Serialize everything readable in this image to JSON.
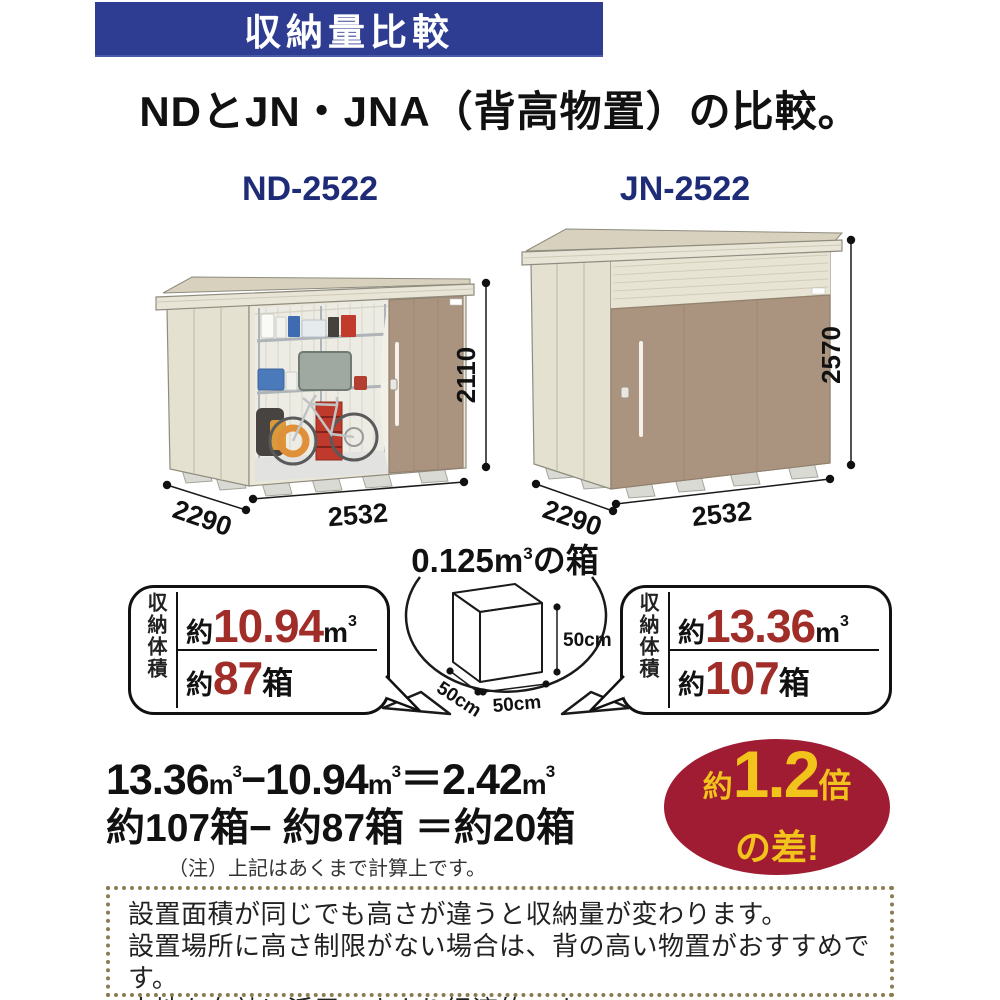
{
  "colors": {
    "banner_blue": "#2e3d91",
    "model_navy": "#1e2c78",
    "value_red": "#a12d28",
    "badge_red": "#a01c33",
    "badge_yellow": "#f2c31b",
    "shed_body_cream": "#ebe7d8",
    "shed_door_taupe": "#ab947f",
    "footer_dot_brown": "#8c7b51"
  },
  "banner": {
    "title": "収納量比較"
  },
  "subtitle": "NDとJN・JNA（背高物置）の比較。",
  "sheds": {
    "left": {
      "model": "ND-2522",
      "width": "2532",
      "depth": "2290",
      "height": "2110"
    },
    "right": {
      "model": "JN-2522",
      "width": "2532",
      "depth": "2290",
      "height": "2570"
    }
  },
  "cube": {
    "title_num": "0.125m",
    "title_sup": "3",
    "title_tail": "の箱",
    "dim_right": "50cm",
    "dim_bottom": "50cm",
    "dim_left": "50cm"
  },
  "volume_left": {
    "label": "収納体積",
    "r1_prefix": "約",
    "r1_value": "10.94",
    "r1_unit": "m",
    "r1_sup": "3",
    "r2_prefix": "約",
    "r2_value": "87",
    "r2_unit": "箱"
  },
  "volume_right": {
    "label": "収納体積",
    "r1_prefix": "約",
    "r1_value": "13.36",
    "r1_unit": "m",
    "r1_sup": "3",
    "r2_prefix": "約",
    "r2_value": "107",
    "r2_unit": "箱"
  },
  "equations": {
    "l1_a": "13.36",
    "l1_op": "−",
    "l1_b": "10.94",
    "l1_eq": "＝",
    "l1_c": "2.42",
    "unit": "m",
    "sup": "3",
    "line2": "約107箱− 約87箱 ＝約20箱",
    "note": "（注）上記はあくまで計算上です。"
  },
  "badge": {
    "prefix": "約",
    "value": "1.2",
    "suffix": "倍",
    "line2": "の差!"
  },
  "footer": {
    "line1": "設置面積が同じでも高さが違うと収納量が変わります。",
    "line2": "設置場所に高さ制限がない場合は、背の高い物置がおすすめです。",
    "line3": "土地を有効に活用できより経済的です。"
  }
}
